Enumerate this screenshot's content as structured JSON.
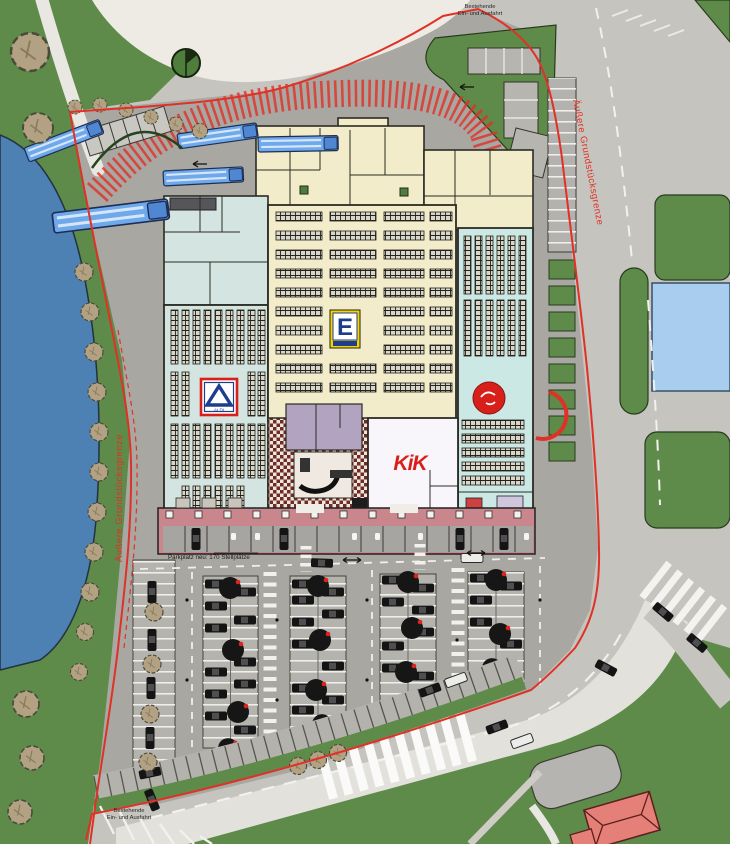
{
  "plan": {
    "labels": {
      "boundary_left": "Äußere Grundstücksgrenze",
      "boundary_right": "Äußere Grundstücksgrenze",
      "entrance_top_line1": "Bestehende",
      "entrance_top_line2": "Ein- und Ausfahrt",
      "entrance_bottom_line1": "Bestehende",
      "entrance_bottom_line2": "Ein- und Ausfahrt",
      "parking_note": "Parkplatz neu: 170 Stellplätze"
    },
    "stores": {
      "aldi_label": "ALDI",
      "edeka_initial": "E",
      "kik_label": "KiK"
    },
    "colors": {
      "boundary_red": "#e03127",
      "logo_red": "#d8201a",
      "park_green": "#5e8b49",
      "lake_blue": "#4d80b3",
      "basin_blue": "#a9cdee",
      "road_light": "#c6c4bf",
      "road_white": "#e3e1dc",
      "site_gray": "#a9a7a2",
      "building_cream": "#f2ecca",
      "building_teal": "#d4e5e1",
      "building_cyan": "#cbe8e4",
      "colonnade_pink": "#c9868c",
      "kik_white": "#f8f6fb",
      "mall_purple": "#b2a4c0",
      "truck_blue": "#6fa9ec",
      "aldi_blue": "#1d3e8f",
      "edeka_yellow": "#f7d400",
      "tree_tan": "#b3a184",
      "tree_dark": "#161616",
      "roof_red": "#e58079"
    }
  }
}
